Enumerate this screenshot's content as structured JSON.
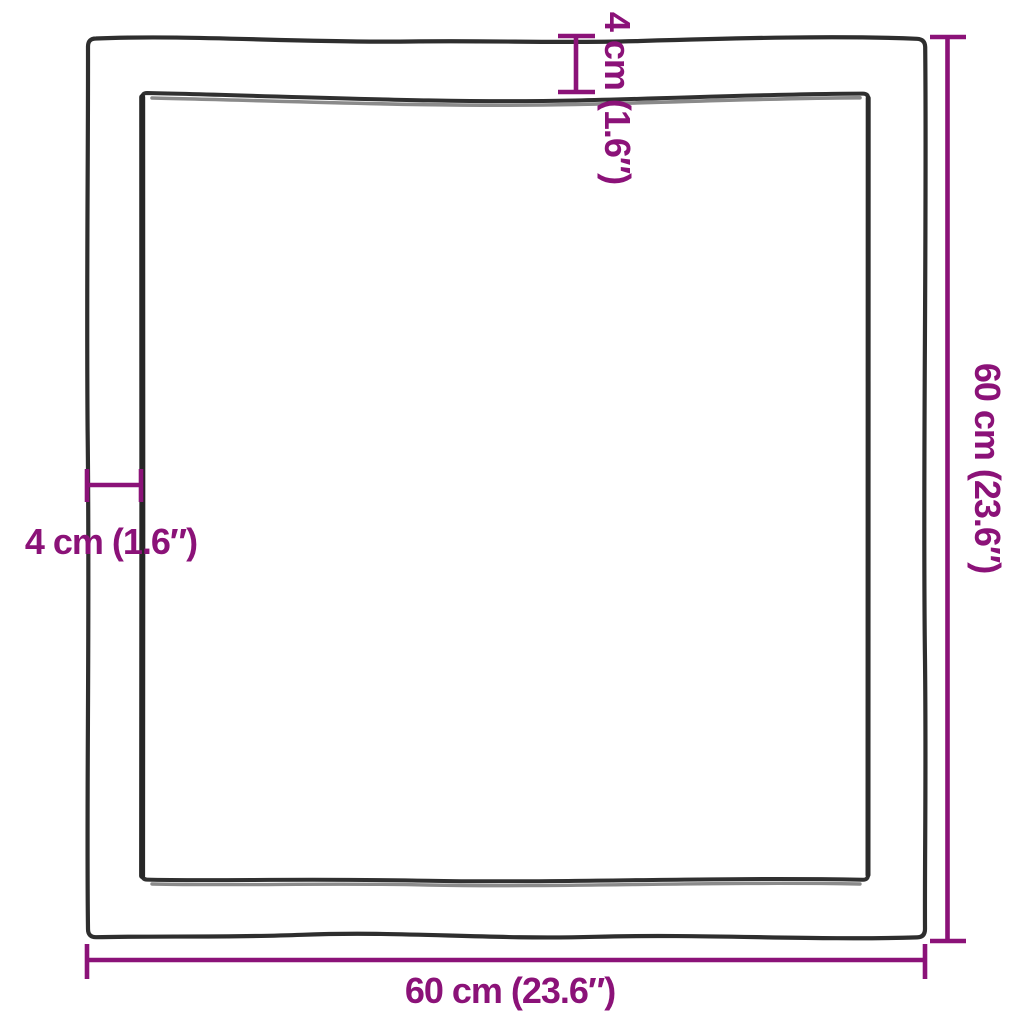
{
  "diagram": {
    "type": "product-dimension-diagram",
    "labels": {
      "top_thickness": "4 cm (1.6″)",
      "left_thickness": "4 cm (1.6″)",
      "right_height": "60 cm (23.6″)",
      "bottom_width": "60 cm (23.6″)"
    },
    "colors": {
      "dimension_accent": "#8B1278",
      "outline_dark": "#2E2E2E",
      "bevel_gray": "#8A8A8A",
      "background": "#FFFFFF"
    }
  }
}
